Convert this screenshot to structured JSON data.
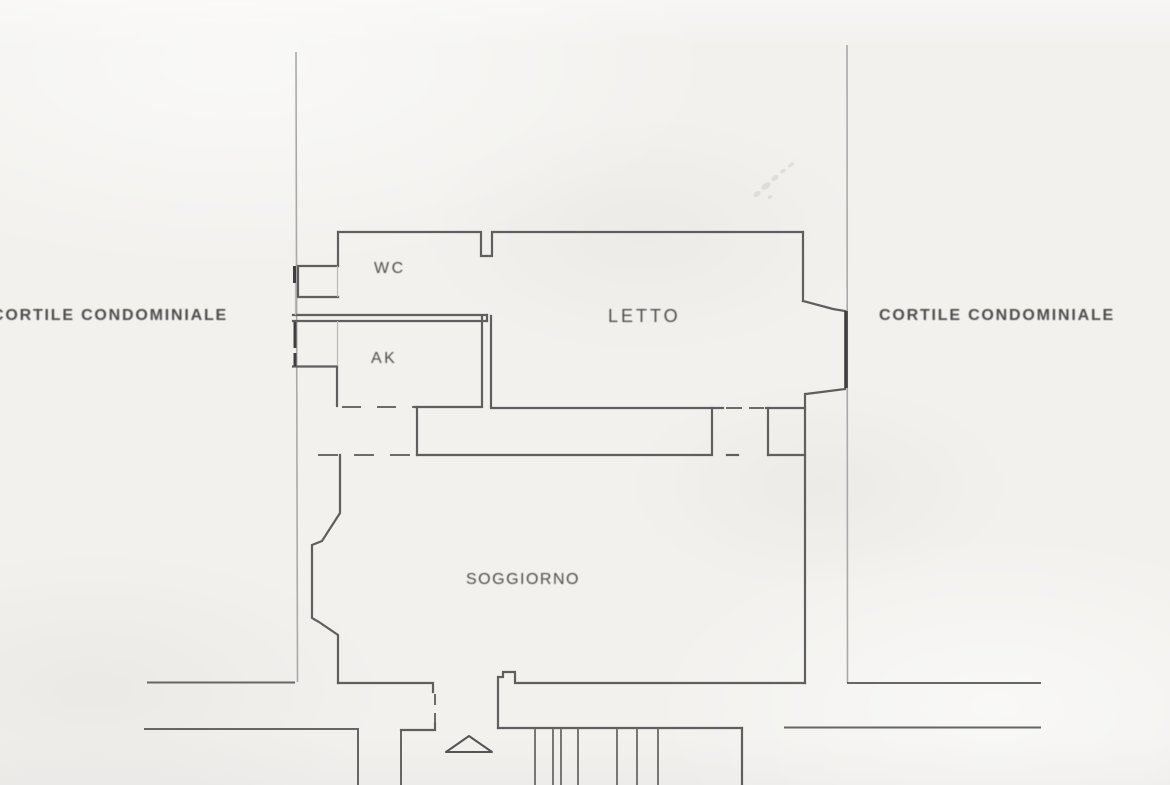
{
  "labels": {
    "courtyard_left": "CORTILE CONDOMINIALE",
    "courtyard_right": "CORTILE CONDOMINIALE",
    "wc": "WC",
    "ak": "AK",
    "letto": "LETTO",
    "soggiorno": "SOGGIORNO"
  },
  "colors": {
    "paper": "#f2f1ee",
    "wall": "#5f5f5f",
    "boundary": "#a9a9a9",
    "dash": "#6b6b6b",
    "window": "#3f3f3f",
    "text": "#4d4d4d"
  }
}
